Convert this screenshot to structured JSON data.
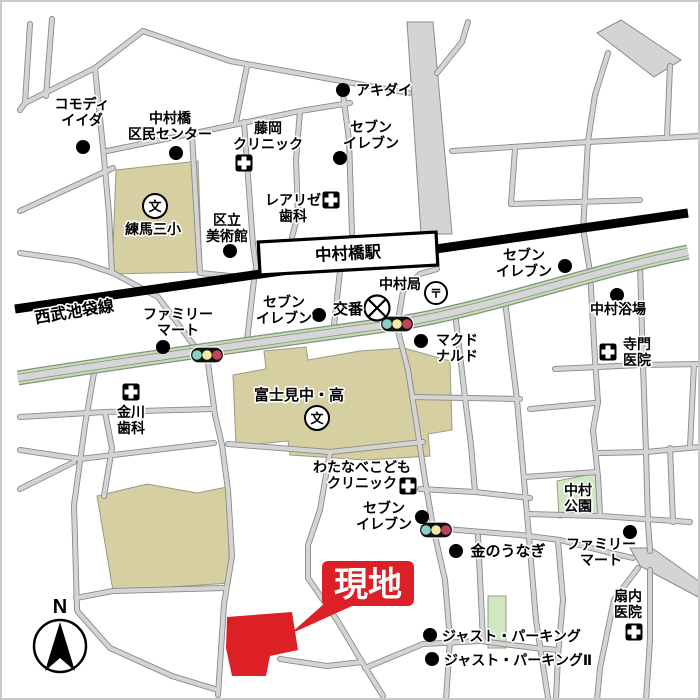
{
  "callout": {
    "label": "現地"
  },
  "station": {
    "label": "中村橋駅"
  },
  "railway": {
    "label": "西武池袋線"
  },
  "compass": {
    "label": "N"
  },
  "symbols": {
    "school_glyph": "文",
    "post_glyph": "〒"
  },
  "colors": {
    "road_fill": "#d4d4d4",
    "road_edge": "#8a8a8a",
    "railway": "#000000",
    "green_road_edge": "#bfe0ab",
    "building_beige": "#d6cfa1",
    "park_green": "#cfe8c2",
    "site_red": "#dd1f26",
    "dot_black": "#000000",
    "traffic_light_green": "#86d2c6",
    "traffic_light_yellow": "#f1eb9e",
    "traffic_light_red": "#bf4458"
  },
  "traffic_lights": [
    {
      "x": 207,
      "y": 355
    },
    {
      "x": 397,
      "y": 324
    },
    {
      "x": 436,
      "y": 530
    }
  ],
  "pois": [
    {
      "id": "commodi-iida",
      "text": "コモディ\nイイダ",
      "x": 82,
      "y": 109,
      "marker": {
        "type": "dot",
        "x": 83,
        "y": 147
      }
    },
    {
      "id": "nakamurabashi-kumin-center",
      "text": "中村橋\n区民センター",
      "x": 170,
      "y": 123,
      "marker": {
        "type": "dot",
        "x": 176,
        "y": 153
      }
    },
    {
      "id": "fujioka-clinic",
      "text": "藤岡\nクリニック",
      "x": 268,
      "y": 133,
      "marker": {
        "type": "hospital",
        "x": 244,
        "y": 163
      }
    },
    {
      "id": "akidai",
      "text": "アキダイ",
      "x": 356,
      "y": 95,
      "anchor": "start",
      "marker": {
        "type": "dot",
        "x": 343,
        "y": 90
      }
    },
    {
      "id": "seven-eleven-north",
      "text": "セブン\nイレブン",
      "x": 371,
      "y": 132,
      "marker": {
        "type": "dot",
        "x": 340,
        "y": 158
      }
    },
    {
      "id": "nerima-daisan-elementary",
      "text": "練馬三小",
      "x": 153,
      "y": 234,
      "marker": {
        "type": "school",
        "x": 155,
        "y": 206
      }
    },
    {
      "id": "kuritsu-art-museum",
      "text": "区立\n美術館",
      "x": 227,
      "y": 225,
      "marker": {
        "type": "dot",
        "x": 230,
        "y": 251
      }
    },
    {
      "id": "realize-dental",
      "text": "レアリゼ\n歯科",
      "x": 293,
      "y": 205,
      "marker": {
        "type": "hospital",
        "x": 331,
        "y": 200
      }
    },
    {
      "id": "seibu-ikebukuro-line",
      "text": "西武池袋線",
      "x": 75,
      "y": 317,
      "size": 16,
      "rotate": -9
    },
    {
      "id": "family-mart-west",
      "text": "ファミリー\nマート",
      "x": 178,
      "y": 319,
      "marker": {
        "type": "dot",
        "x": 163,
        "y": 347
      }
    },
    {
      "id": "seven-eleven-station",
      "text": "セブン\nイレブン",
      "x": 284,
      "y": 307,
      "marker": {
        "type": "dot",
        "x": 319,
        "y": 315
      }
    },
    {
      "id": "koban",
      "text": "交番",
      "x": 348,
      "y": 314,
      "size": 15,
      "marker": {
        "type": "koban",
        "x": 377,
        "y": 308
      }
    },
    {
      "id": "nakamura-post-office",
      "text": "中村局",
      "x": 400,
      "y": 289,
      "marker": {
        "type": "post",
        "x": 436,
        "y": 293
      }
    },
    {
      "id": "mcdonalds",
      "text": "マクド\nナルド",
      "x": 457,
      "y": 345,
      "marker": {
        "type": "dot",
        "x": 421,
        "y": 341
      }
    },
    {
      "id": "seven-eleven-east",
      "text": "セブン\nイレブン",
      "x": 524,
      "y": 260,
      "marker": {
        "type": "dot",
        "x": 565,
        "y": 266
      }
    },
    {
      "id": "nakamura-yokujo",
      "text": "中村浴場",
      "x": 618,
      "y": 314,
      "marker": {
        "type": "dot",
        "x": 617,
        "y": 295
      }
    },
    {
      "id": "terakado-clinic",
      "text": "寺門\n医院",
      "x": 637,
      "y": 349,
      "marker": {
        "type": "hospital",
        "x": 608,
        "y": 352
      }
    },
    {
      "id": "kanagawa-dental",
      "text": "金川\n歯科",
      "x": 131,
      "y": 417,
      "marker": {
        "type": "hospital",
        "x": 131,
        "y": 392
      }
    },
    {
      "id": "fujimi-junior-senior-high",
      "text": "富士見中・高",
      "x": 299,
      "y": 400,
      "size": 15,
      "marker": {
        "type": "school",
        "x": 317,
        "y": 418
      }
    },
    {
      "id": "watanabe-kids-clinic",
      "text": "わたなべこども\nクリニック",
      "x": 362,
      "y": 472,
      "marker": {
        "type": "hospital",
        "x": 408,
        "y": 486
      }
    },
    {
      "id": "seven-eleven-south",
      "text": "セブン\nイレブン",
      "x": 384,
      "y": 513,
      "marker": {
        "type": "dot",
        "x": 422,
        "y": 517
      }
    },
    {
      "id": "kin-no-unagi",
      "text": "金のうなぎ",
      "x": 508,
      "y": 556,
      "size": 15,
      "marker": {
        "type": "dot",
        "x": 456,
        "y": 551
      }
    },
    {
      "id": "nakamura-park",
      "text": "中村\n公園",
      "x": 578,
      "y": 495
    },
    {
      "id": "family-mart-south",
      "text": "ファミリー\nマート",
      "x": 601,
      "y": 549,
      "marker": {
        "type": "dot",
        "x": 630,
        "y": 532
      }
    },
    {
      "id": "oginai-clinic",
      "text": "扇内\n医院",
      "x": 628,
      "y": 601,
      "marker": {
        "type": "hospital",
        "x": 634,
        "y": 632
      }
    },
    {
      "id": "just-parking",
      "text": "ジャスト・パーキング",
      "x": 442,
      "y": 641,
      "anchor": "start",
      "marker": {
        "type": "dot",
        "x": 430,
        "y": 635
      }
    },
    {
      "id": "just-parking-2",
      "text": "ジャスト・パーキングⅡ",
      "x": 444,
      "y": 665,
      "anchor": "start",
      "marker": {
        "type": "dot",
        "x": 432,
        "y": 659
      }
    }
  ]
}
